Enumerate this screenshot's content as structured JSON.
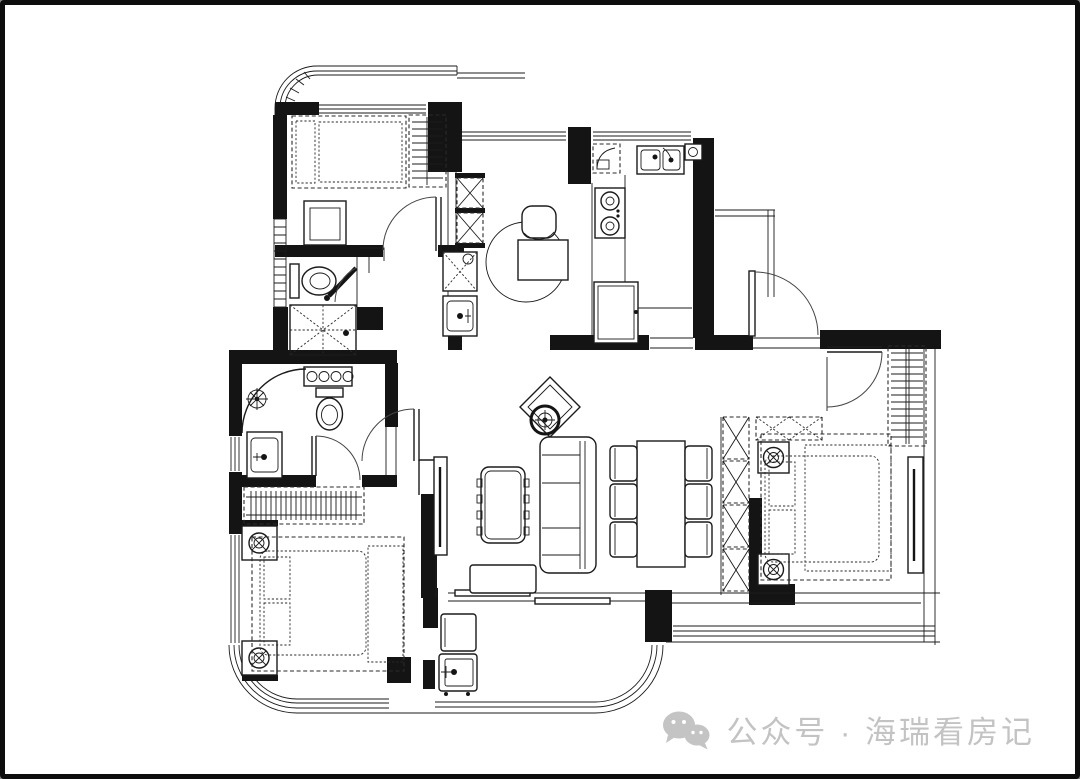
{
  "canvas": {
    "width_px": 1080,
    "height_px": 779,
    "background": "#ffffff",
    "frame_color": "#0d0d0d"
  },
  "palette": {
    "line": "#1b1b1b",
    "wall_fill": "#141414",
    "door_arc": "#444444",
    "watermark_gray": "#c3c3c3"
  },
  "watermark": {
    "icon": "wechat-icon",
    "text": "公众号 · 海瑞看房记"
  },
  "floor_plan": {
    "type": "residential-apartment-floor-plan",
    "style": "black-and-white architectural line drawing, furnished, no text labels or dimensions visible",
    "rooms": [
      {
        "id": "bedroom-top-left",
        "furniture": [
          "double-bed",
          "striped-wardrobe",
          "desk-with-chair"
        ],
        "features": [
          "curved-balcony-corner",
          "top-window"
        ]
      },
      {
        "id": "ensuite-bathroom",
        "fixtures": [
          "toilet",
          "shower-with-drain",
          "swing-door"
        ]
      },
      {
        "id": "common-bathroom",
        "fixtures": [
          "curved-corner-shower",
          "shower-head",
          "towel-rack-four-rings",
          "toilet",
          "washbasin"
        ]
      },
      {
        "id": "bedroom-bottom-left",
        "furniture": [
          "double-bed",
          "nightstand-lamp-x2",
          "hanging-wardrobe"
        ],
        "features": [
          "curved-corner-window",
          "left-window"
        ]
      },
      {
        "id": "study-hall-nook",
        "furniture": [
          "desk",
          "chair",
          "round-rug",
          "x-shelf-cabinets",
          "washer-cabinet",
          "vanity-basin"
        ]
      },
      {
        "id": "kitchen",
        "fixtures": [
          "double-basin-sink",
          "two-burner-gas-stove",
          "hood-appliance",
          "fridge",
          "counter"
        ]
      },
      {
        "id": "entry",
        "features": [
          "outward-swinging-front-door",
          "threshold"
        ]
      },
      {
        "id": "living-room",
        "furniture": [
          "three-seat-sofa",
          "coffee-table",
          "tv-bench",
          "wall-mounted-tv",
          "diamond-accent-chair",
          "ceiling-lamp-symbol"
        ]
      },
      {
        "id": "dining-area",
        "furniture": [
          "dining-table",
          "chair-x6",
          "x-storage-column"
        ]
      },
      {
        "id": "bedroom-right",
        "furniture": [
          "double-bed",
          "nightstand-lamp-x2",
          "hanging-wardrobe",
          "x-dresser",
          "wall-mounted-tv"
        ],
        "features": [
          "bay-window-south"
        ]
      },
      {
        "id": "balcony-bottom",
        "fixtures": [
          "washing-machine",
          "cabinet",
          "sliding-door",
          "curved-glazing-corner"
        ]
      }
    ]
  }
}
